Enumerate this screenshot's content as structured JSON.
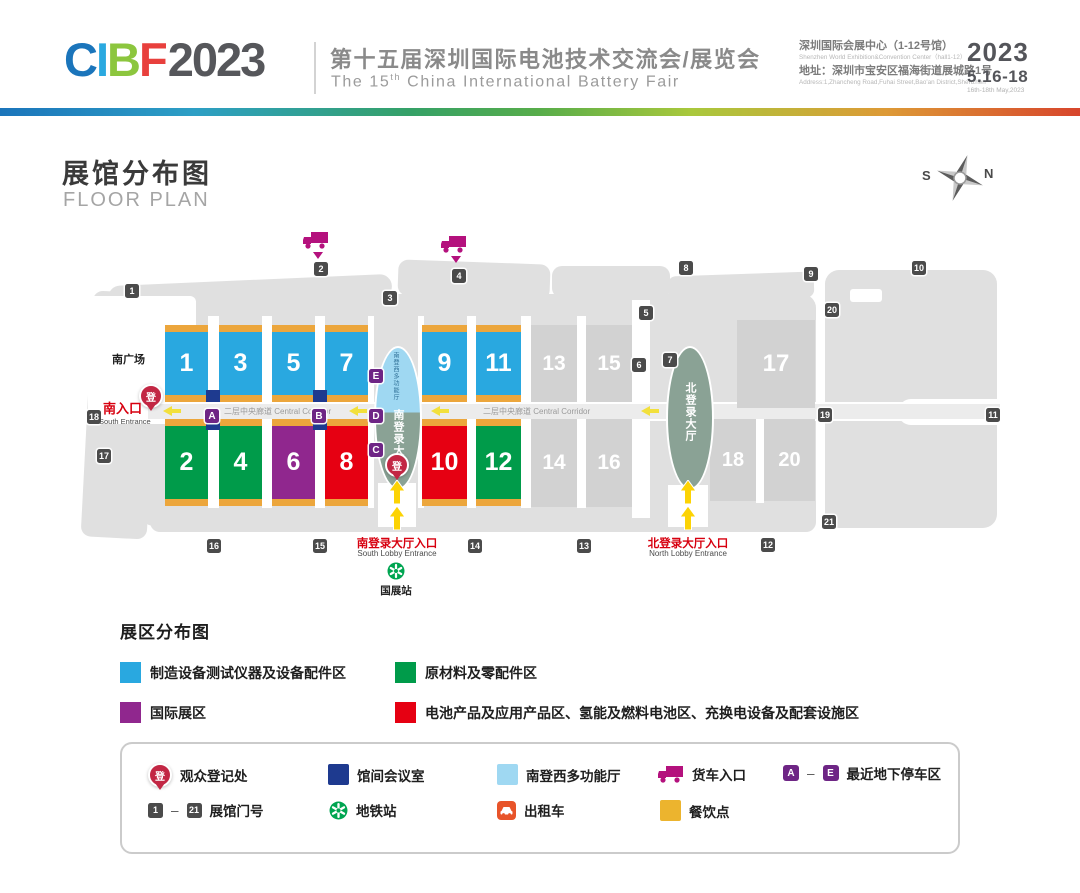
{
  "header": {
    "logo": {
      "l1": "C",
      "l2": "I",
      "l3": "B",
      "l4": "F",
      "year": "2023"
    },
    "title_cn": "第十五届深圳国际电池技术交流会/展览会",
    "title_en": {
      "pre": "The 15",
      "sup": "th",
      "post": " China International Battery Fair"
    },
    "venue_cn": "深圳国际会展中心（1-12号馆）",
    "venue_en": "Shenzhen World Exhibition&Convention Center（hall1-12）",
    "address_cn": "地址：深圳市宝安区福海街道展城路1号",
    "address_en": "Address:1,Zhancheng Road,Fuhai Street,Bao'an District,Shenzhen",
    "date_year": "2023",
    "date_range": "5.16-18",
    "date_en": "16th-18th May,2023"
  },
  "floor_plan": {
    "title_cn": "展馆分布图",
    "title_en": "FLOOR PLAN"
  },
  "compass": {
    "s": "S",
    "n": "N"
  },
  "map": {
    "halls": {
      "1": "1",
      "2": "2",
      "3": "3",
      "4": "4",
      "5": "5",
      "6": "6",
      "7": "7",
      "8": "8",
      "9": "9",
      "10": "10",
      "11": "11",
      "12": "12",
      "13": "13",
      "14": "14",
      "15": "15",
      "16": "16",
      "17": "17",
      "18": "18",
      "20": "20"
    },
    "gates": [
      "1",
      "2",
      "3",
      "4",
      "5",
      "6",
      "7",
      "8",
      "9",
      "10",
      "11",
      "12",
      "13",
      "14",
      "15",
      "16",
      "17",
      "18",
      "19",
      "20",
      "21"
    ],
    "parking": [
      "A",
      "B",
      "C",
      "D",
      "E"
    ],
    "corridor_label": "二层中央廊道  Central Corridor",
    "south_plaza": "南广场",
    "south_entrance_cn": "南入口",
    "south_entrance_en": "South Entrance",
    "south_lobby_vertical": "南登录大厅",
    "south_multi_hall_vertical": "南登西多功能厅",
    "north_lobby_vertical": "北登录大厅",
    "south_lobby_entrance_cn": "南登录大厅入口",
    "south_lobby_entrance_en": "South Lobby Entrance",
    "north_lobby_entrance_cn": "北登录大厅入口",
    "north_lobby_entrance_en": "North Lobby Entrance",
    "metro_station": "国展站",
    "reg_char": "登"
  },
  "zones_legend": {
    "title": "展区分布图",
    "items": [
      {
        "label": "制造设备测试仪器及设备配件区",
        "color": "#29a8e0"
      },
      {
        "label": "原材料及零配件区",
        "color": "#009b4a"
      },
      {
        "label": "国际展区",
        "color": "#90278e"
      },
      {
        "label": "电池产品及应用产品区、氢能及燃料电池区、充换电设备及配套设施区",
        "color": "#e60012"
      }
    ]
  },
  "icons_legend": {
    "visitor_registration": "观众登记处",
    "meeting_room": "馆间会议室",
    "multi_function_hall": "南登西多功能厅",
    "truck_entrance": "货车入口",
    "parking_label": "最近地下停车区",
    "parking_from": "A",
    "parking_to": "E",
    "gate_label": "展馆门号",
    "gate_from": "1",
    "gate_to": "21",
    "dash": "–",
    "metro": "地铁站",
    "taxi": "出租车",
    "food": "餐饮点"
  },
  "colors": {
    "hall_blue": "#29a8e0",
    "hall_green": "#009b4a",
    "hall_purple": "#90278e",
    "hall_red": "#e60012",
    "strip_orange": "#eca63c",
    "parking_purple": "#6e2585",
    "meeting_blue": "#1e3a8f",
    "lobby_sage": "#8aa295",
    "multi_hall_lightblue": "#9fd8f2",
    "pin_red": "#c22744",
    "truck_magenta": "#b4117d",
    "metro_green": "#00a551",
    "taxi_orange": "#e8542a",
    "food_yellow": "#ecb42e",
    "gate_gray": "#4b4b4b"
  }
}
